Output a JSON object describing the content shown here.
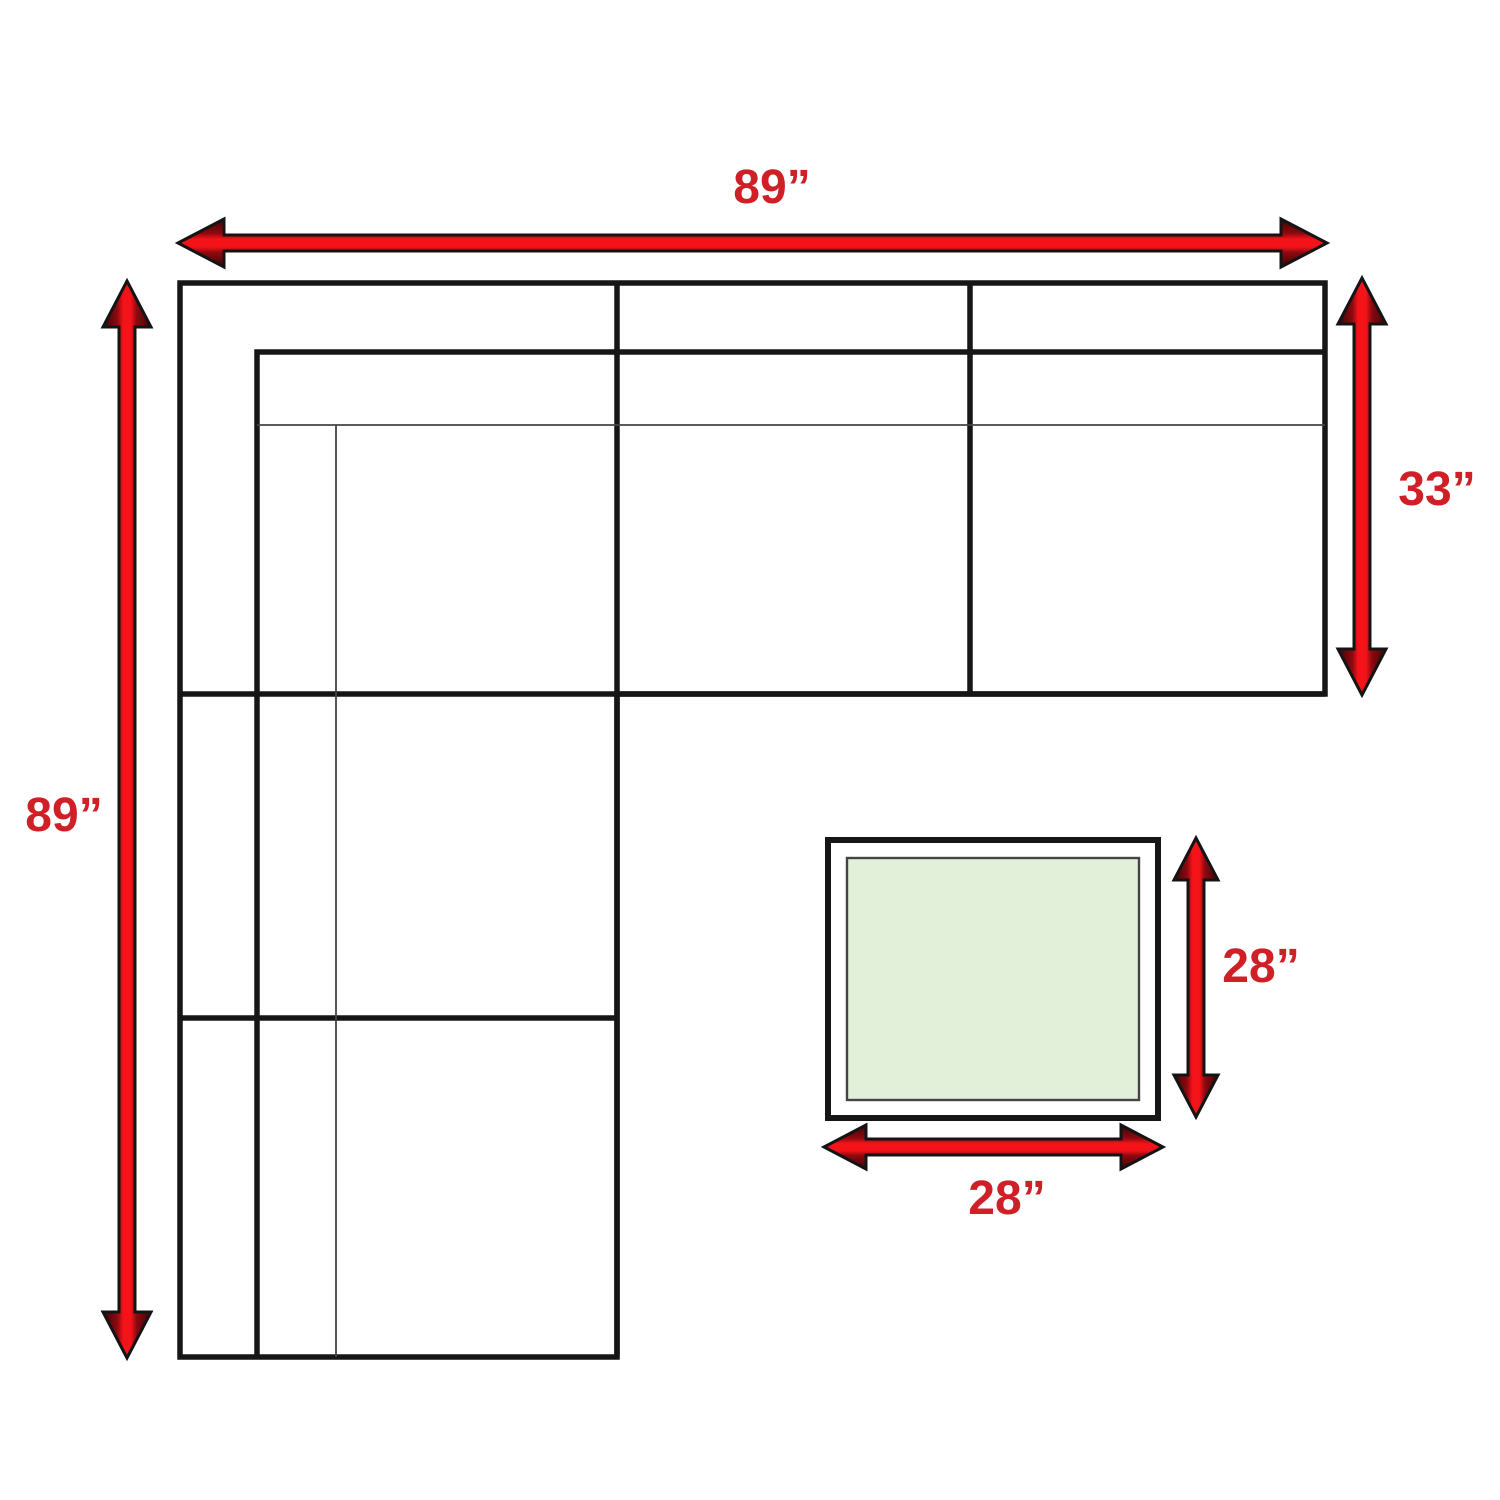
{
  "diagram": {
    "name": "sectional-sofa-and-ottoman-dimensions",
    "sofa": {
      "width_label": "89”",
      "height_label": "89”",
      "depth_label": "33”"
    },
    "ottoman": {
      "height_label": "28”",
      "width_label": "28”"
    }
  },
  "colors": {
    "background": "#ffffff",
    "line_black": "#161616",
    "line_thin": "#444444",
    "arrow_outline": "#141414",
    "arrow_red_bright": "#f41319",
    "arrow_red_mid": "#8c0a10",
    "arrow_red_dark": "#3c0405",
    "label_red": "#d02027",
    "ottoman_fill": "#e2efd9"
  }
}
